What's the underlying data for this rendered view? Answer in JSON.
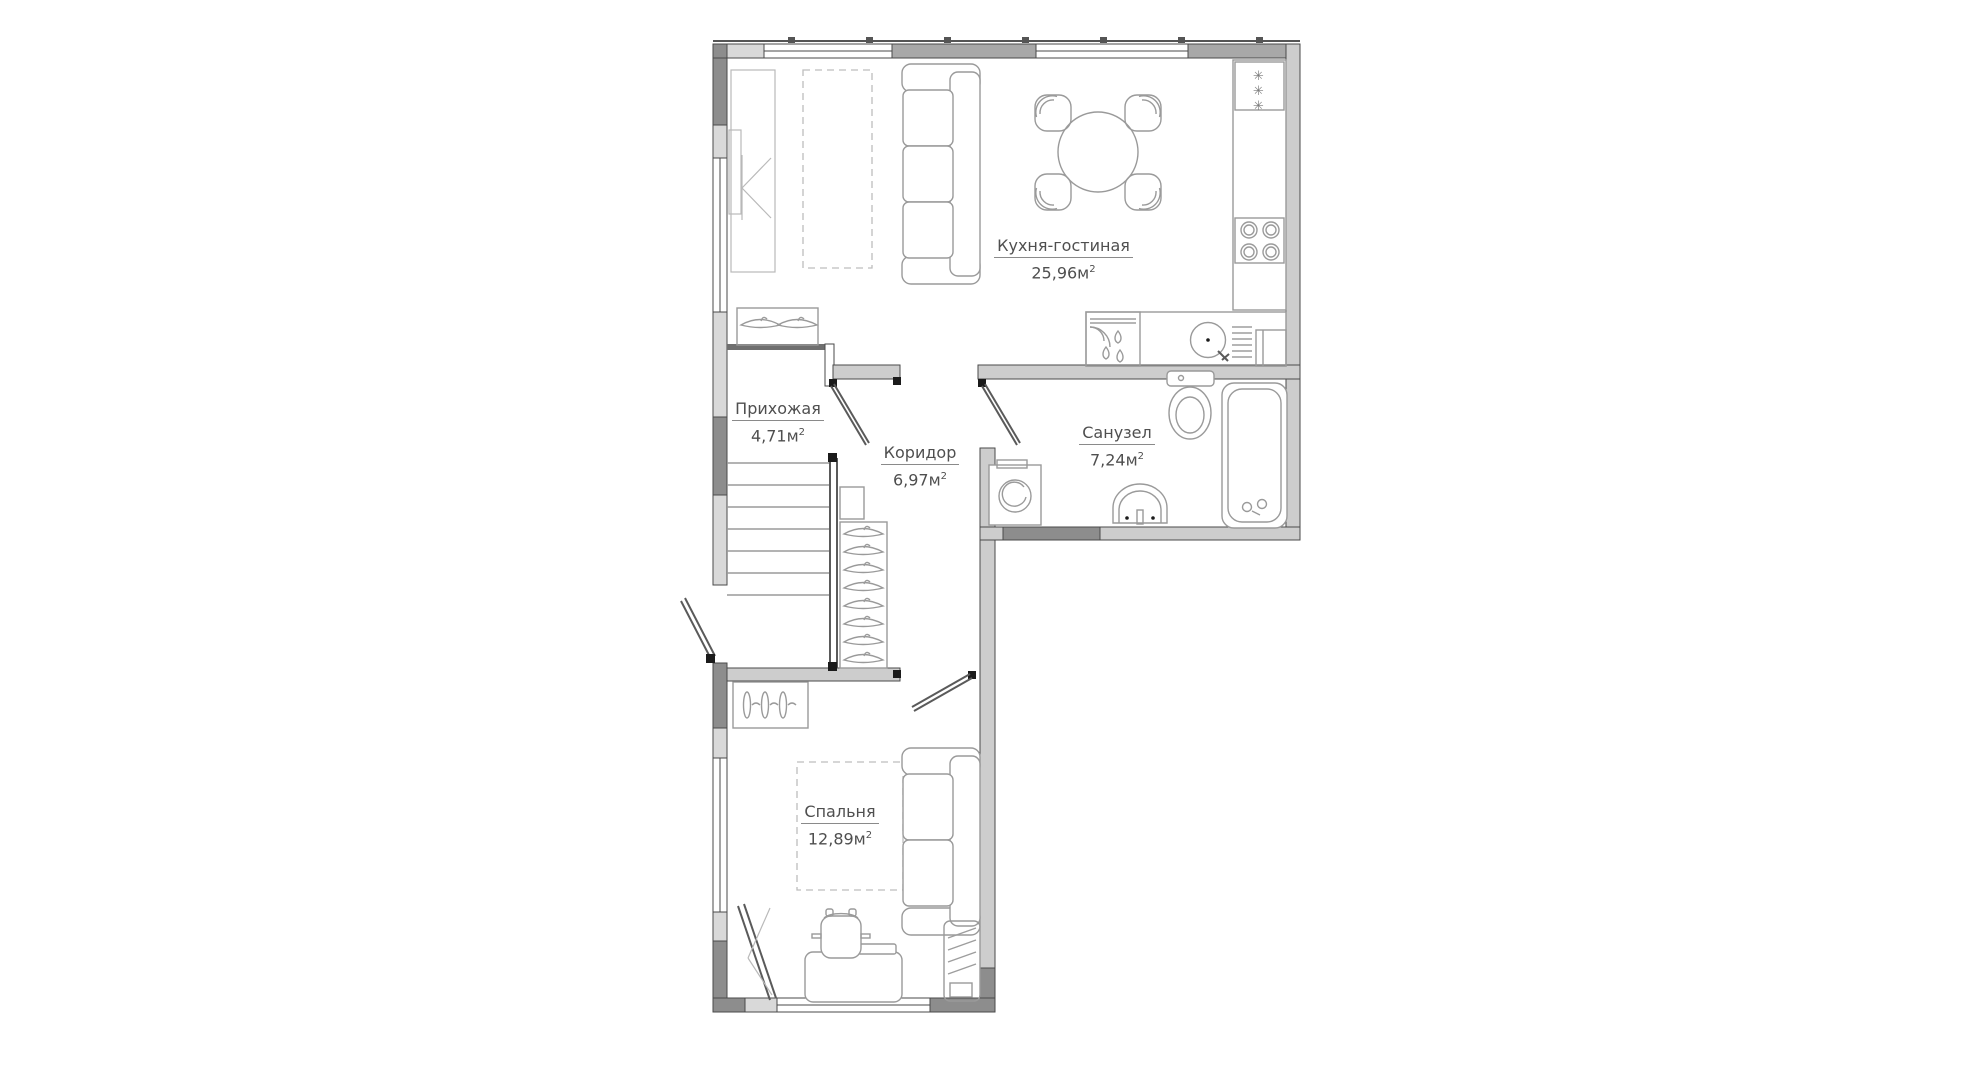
{
  "rooms": [
    {
      "id": "kitchen-living",
      "name": "Кухня-гостиная",
      "area": "25,96м",
      "sup": "2"
    },
    {
      "id": "hallway",
      "name": "Прихожая",
      "area": "4,71м",
      "sup": "2"
    },
    {
      "id": "corridor",
      "name": "Коридор",
      "area": "6,97м",
      "sup": "2"
    },
    {
      "id": "bathroom",
      "name": "Санузел",
      "area": "7,24м",
      "sup": "2"
    },
    {
      "id": "bedroom",
      "name": "Спальня",
      "area": "12,89м",
      "sup": "2"
    }
  ],
  "fridge": {
    "mark": "✳"
  },
  "colors": {
    "wall_dark": "#8d8d8d",
    "wall_mid": "#a8a8a8",
    "wall_light": "#cdcdcd",
    "wall_sill": "#d9d9d9",
    "line": "#4a4a4a",
    "furn": "#9a9a9a",
    "text": "#4f4f4f",
    "bg": "#ffffff"
  }
}
